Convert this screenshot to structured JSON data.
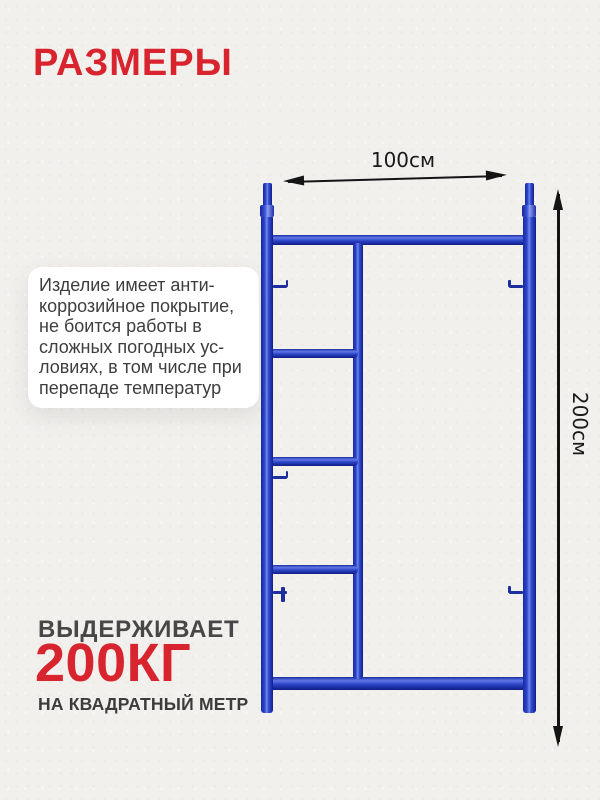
{
  "title": "РАЗМЕРЫ",
  "colors": {
    "bg": "#f2f0ed",
    "accent_red": "#d8242e",
    "heading_gray": "#474747",
    "text_dark": "#3e3e3e",
    "arrow_black": "#141414",
    "blue_main": "#2b43c6",
    "blue_dark": "#111e8a",
    "blue_light": "#7187ec",
    "card_bg": "#ffffff"
  },
  "description_card": {
    "lines": [
      "Изделие имеет анти-",
      "коррозийное покрытие,",
      "не боится работы в",
      "сложных погодных ус-",
      "ловиях, в том числе при",
      "перепаде температур"
    ]
  },
  "dimensions": {
    "width_label": "100см",
    "height_label": "200см"
  },
  "capacity": {
    "heading": "ВЫДЕРЖИВАЕТ",
    "value": "200КГ",
    "unit": "НА КВАДРАТНЫЙ МЕТР"
  },
  "diagram": {
    "name": "scaffold-ladder-frame",
    "rung_count": 3
  }
}
